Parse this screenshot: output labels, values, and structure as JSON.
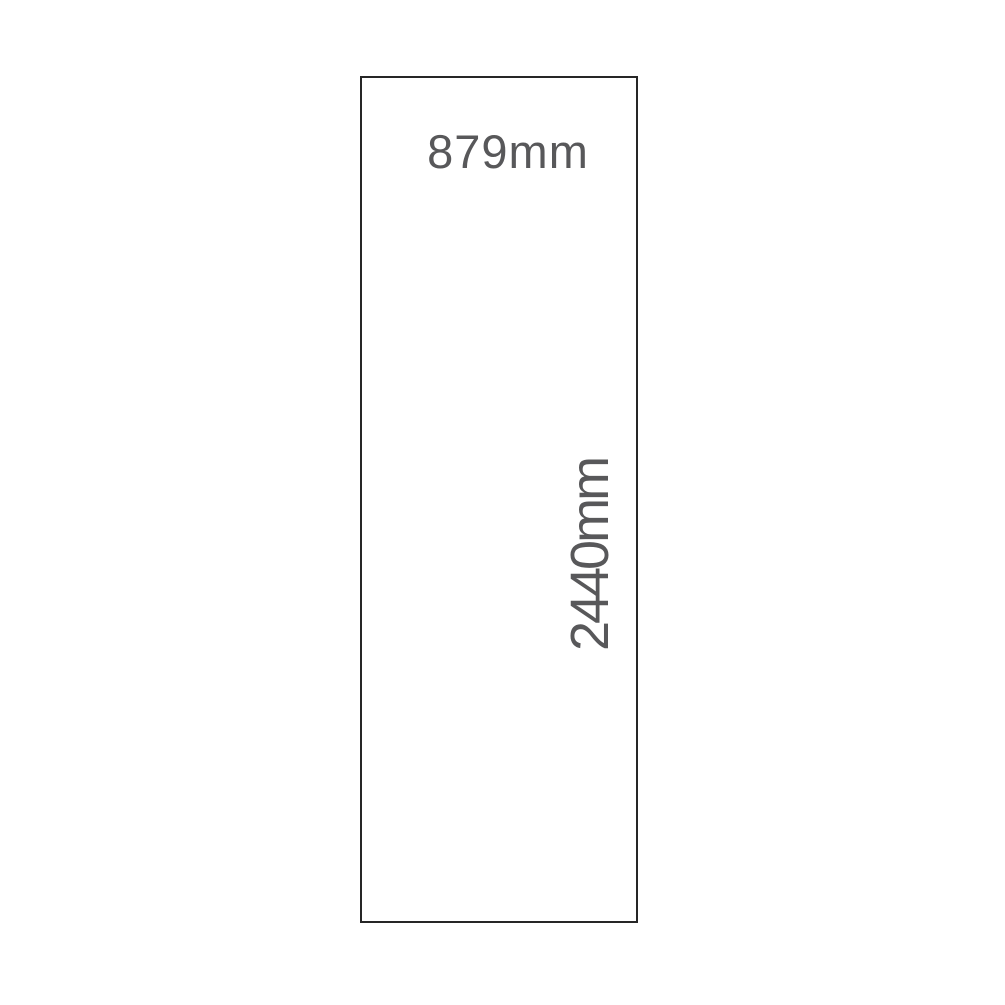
{
  "diagram": {
    "description": "panel-dimension-drawing",
    "background": "#ffffff",
    "panel": {
      "fill": "#ffffff",
      "border_color": "#262626",
      "width_label": "879mm",
      "height_label": "2440mm",
      "label_color": "#58585a",
      "width_mm": 879,
      "height_mm": 2440
    }
  }
}
